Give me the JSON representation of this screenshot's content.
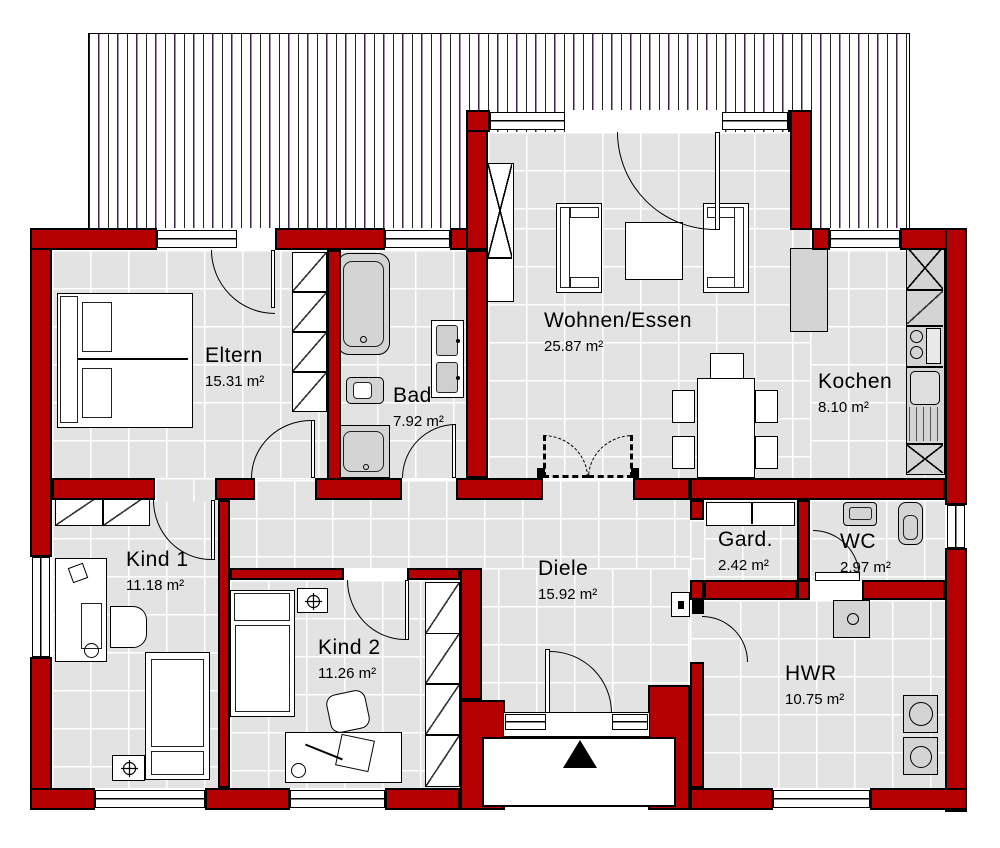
{
  "plan": {
    "type": "floor-plan",
    "rooms": [
      {
        "name": "Eltern",
        "area": "15.31 m²"
      },
      {
        "name": "Bad",
        "area": "7.92 m²"
      },
      {
        "name": "Wohnen/Essen",
        "area": "25.87 m²"
      },
      {
        "name": "Kochen",
        "area": "8.10 m²"
      },
      {
        "name": "Kind 1",
        "area": "11.18 m²"
      },
      {
        "name": "Kind 2",
        "area": "11.26 m²"
      },
      {
        "name": "Diele",
        "area": "15.92 m²"
      },
      {
        "name": "Gard.",
        "area": "2.42 m²"
      },
      {
        "name": "WC",
        "area": "2.97 m²"
      },
      {
        "name": "HWR",
        "area": "10.75 m²"
      }
    ],
    "colors": {
      "wall": "#b40000",
      "wall_outline": "#000000",
      "floor": "#e3e3e3",
      "fixture_gray": "#d4d4d4",
      "hatch_line_dark": "#222222",
      "hatch_line_purple": "#3f2347"
    },
    "markers": {
      "entrance": "black-triangle"
    }
  }
}
